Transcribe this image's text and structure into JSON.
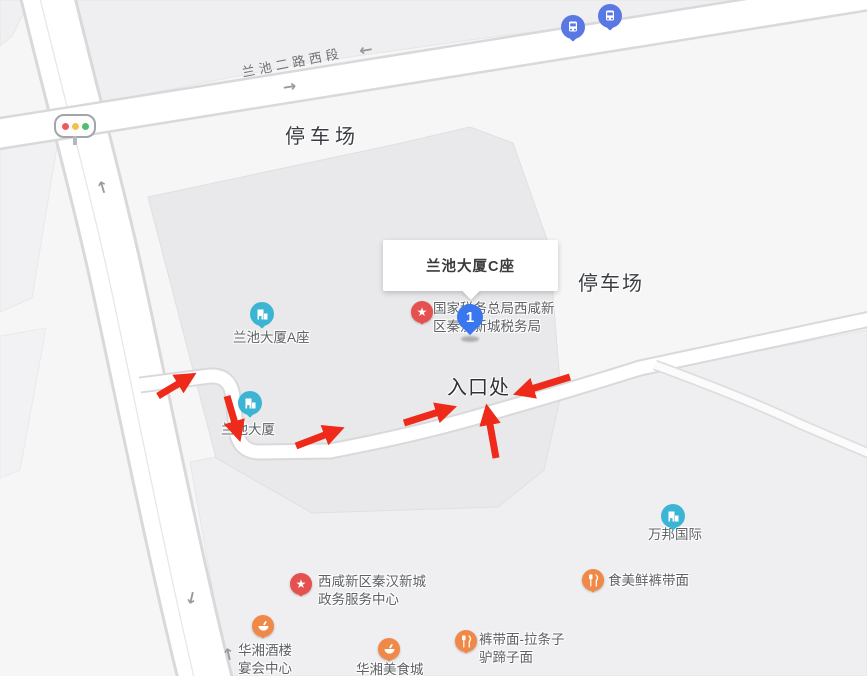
{
  "map_ui": {
    "road_name": "兰池二路西段",
    "labels": {
      "parking_north": "停车场",
      "parking_east": "停车场",
      "entrance": "入口处"
    },
    "popup": {
      "title": "兰池大厦C座"
    },
    "route_marker": {
      "number": "1"
    },
    "pois": [
      {
        "id": "lanchi-tower-a",
        "label": "兰池大厦A座",
        "icon": "building-icon",
        "pin_color": "#3cb5d4"
      },
      {
        "id": "lanchi-tower",
        "label": "兰池大厦",
        "icon": "building-icon",
        "pin_color": "#3cb5d4"
      },
      {
        "id": "tax-bureau",
        "label": "国家税务总局西咸新\n区秦汉新城税务局",
        "icon": "star-icon",
        "pin_color": "#e5514f"
      },
      {
        "id": "wanbang-intl",
        "label": "万邦国际",
        "icon": "building-icon",
        "pin_color": "#3cb5d4"
      },
      {
        "id": "gov-service-center",
        "label": "西咸新区秦汉新城\n政务服务中心",
        "icon": "star-icon",
        "pin_color": "#e5514f"
      },
      {
        "id": "shimei-noodle",
        "label": "食美鲜裤带面",
        "icon": "fork-knife-icon",
        "pin_color": "#f08948"
      },
      {
        "id": "kudaimian-latiaozi",
        "label": "裤带面-拉条子\n驴蹄子面",
        "icon": "fork-knife-icon",
        "pin_color": "#f08948"
      },
      {
        "id": "huaxiang-banquet",
        "label": "华湘酒楼\n宴会中心",
        "icon": "bowl-icon",
        "pin_color": "#f08948"
      },
      {
        "id": "huaxiang-food-city",
        "label": "华湘美食城",
        "icon": "bowl-icon",
        "pin_color": "#f08948"
      }
    ],
    "transit": {
      "bus_stop_count": 2,
      "bus_icon": "bus-icon"
    },
    "traffic_light": {
      "icon": "traffic-light-icon"
    },
    "annotations": {
      "red_arrow_count": 6,
      "arrow_color": "#ee2b1a"
    },
    "colors": {
      "background": "#f6f6f7",
      "block": "#efeff1",
      "building_block": "#e9e9eb",
      "road_fill": "#ffffff",
      "road_casing": "#d9d9db",
      "poi_teal": "#3cb5d4",
      "poi_red": "#e5514f",
      "poi_orange": "#f08948",
      "bus_blue": "#5a78e4",
      "route_blue": "#3a76ee"
    }
  }
}
